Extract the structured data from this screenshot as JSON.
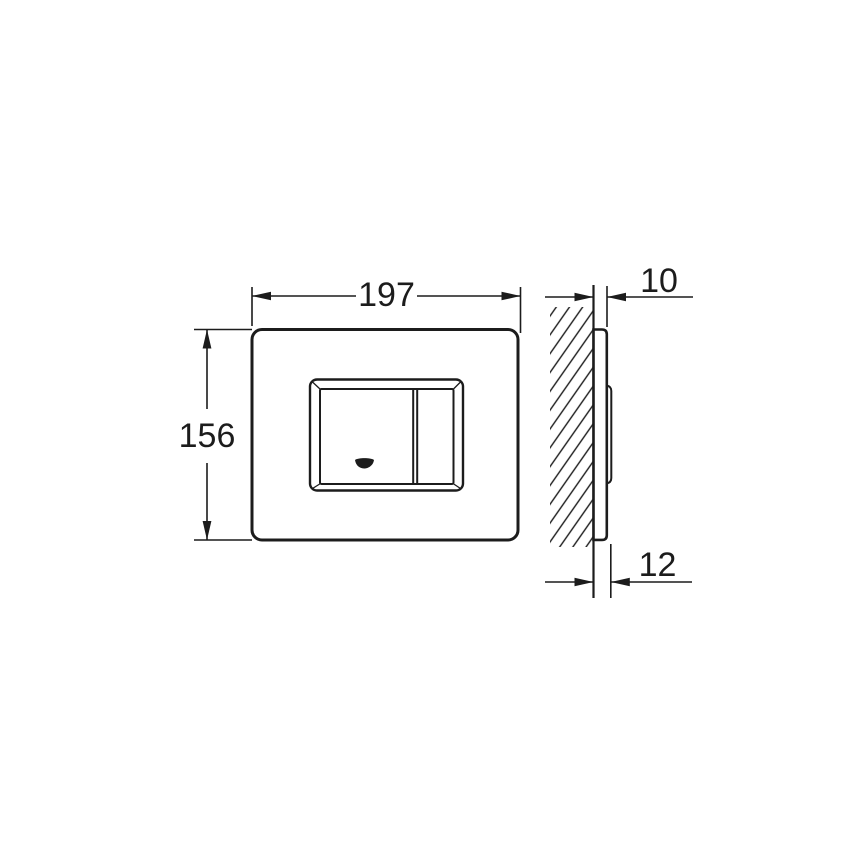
{
  "colors": {
    "line": "#1c1c1c",
    "background": "#ffffff"
  },
  "diagram": {
    "type": "technical-drawing",
    "front_view": {
      "width": "197",
      "height": "156"
    },
    "side_view": {
      "plate_depth": "10",
      "total_depth": "12"
    },
    "marks": {
      "button_logo": "logo-mark"
    }
  }
}
